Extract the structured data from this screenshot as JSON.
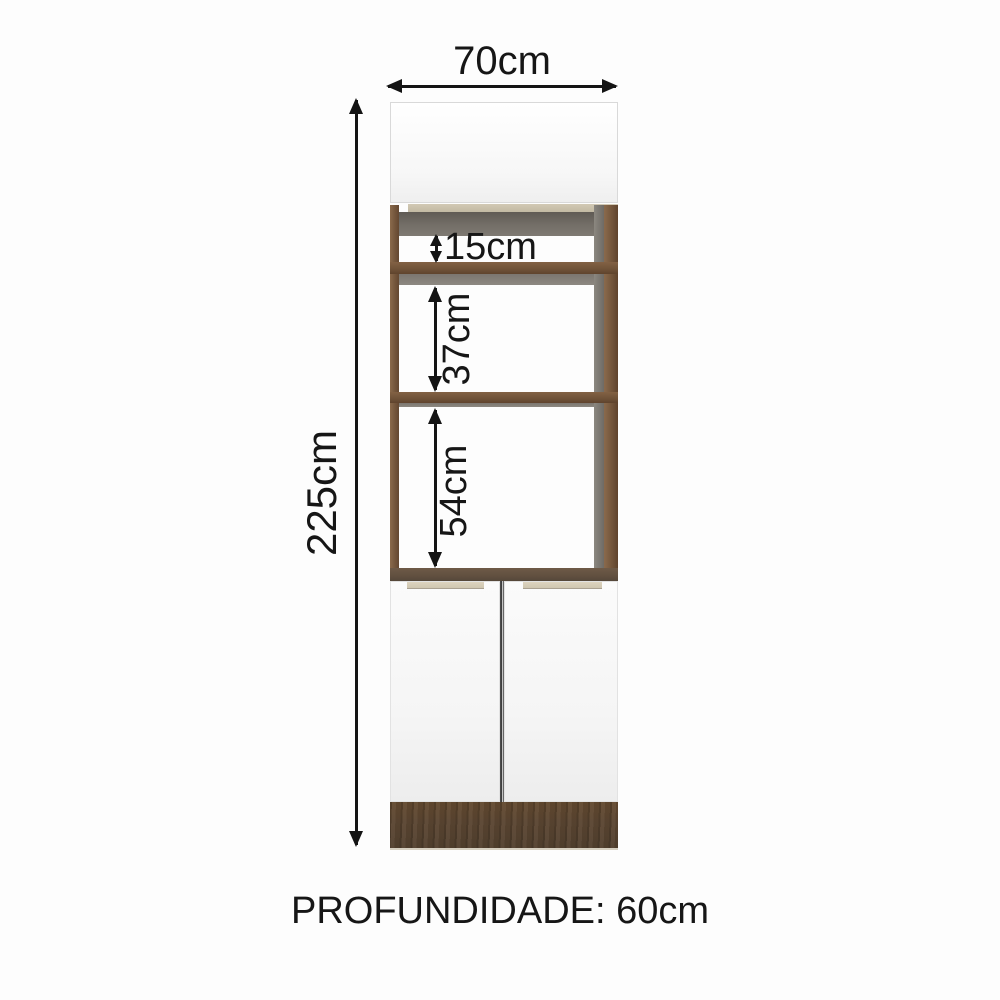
{
  "labels": {
    "width": "70cm",
    "height": "225cm",
    "gap_top": "15cm",
    "gap_middle": "37cm",
    "gap_bottom": "54cm",
    "depth": "PROFUNDIDADE: 60cm"
  },
  "colors": {
    "background": "#fdfdfd",
    "arrow_and_text": "#141414",
    "wood_brown": "#74563c",
    "wood_dark_base": "#5a4531",
    "tan_trim": "#cdc4ad",
    "shadow_gray": "#6e6963",
    "shelf_gray": "#8a857e",
    "door_white": "#fafafa"
  }
}
